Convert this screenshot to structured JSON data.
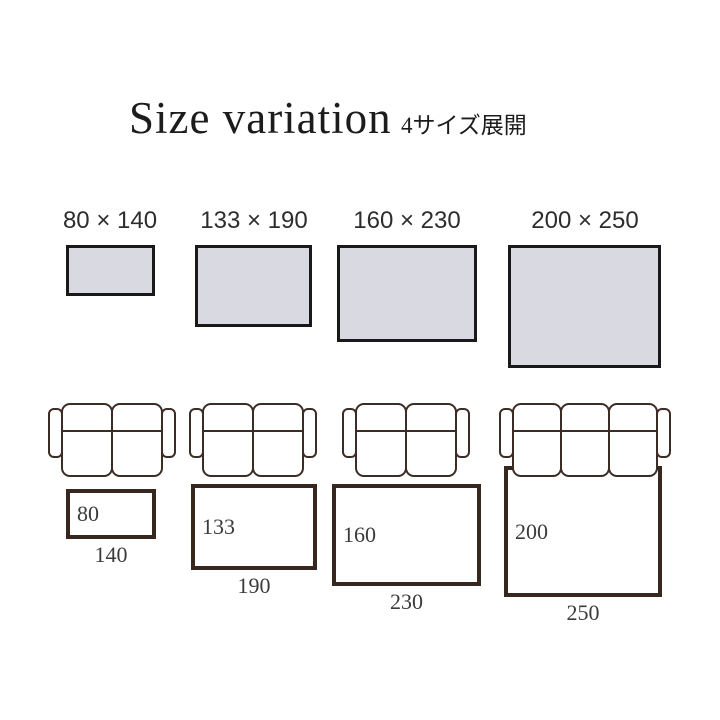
{
  "title": "Size variation",
  "subtitle": "4サイズ展開",
  "colors": {
    "background": "#ffffff",
    "swatch_fill": "#d9d9e2",
    "swatch_border": "#191919",
    "sofa_line": "#3b2d25",
    "rug_border": "#36281f",
    "text_dark": "#1c1c1c",
    "text_gray": "#3b3b3b"
  },
  "variants": [
    {
      "size_label": "80 × 140",
      "height_label": "80",
      "width_label": "140",
      "width_cm": 140,
      "height_cm": 80,
      "sofa_seats": 2
    },
    {
      "size_label": "133 × 190",
      "height_label": "133",
      "width_label": "190",
      "width_cm": 190,
      "height_cm": 133,
      "sofa_seats": 2
    },
    {
      "size_label": "160 × 230",
      "height_label": "160",
      "width_label": "230",
      "width_cm": 230,
      "height_cm": 160,
      "sofa_seats": 2
    },
    {
      "size_label": "200 × 250",
      "height_label": "200",
      "width_label": "250",
      "width_cm": 250,
      "height_cm": 200,
      "sofa_seats": 3
    }
  ]
}
